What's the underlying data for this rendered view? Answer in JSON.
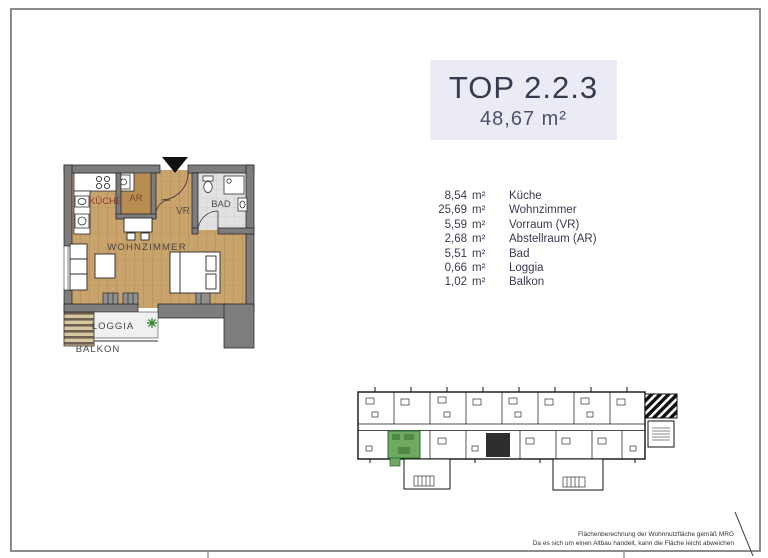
{
  "page": {
    "title": "TOP 2.2.3",
    "total_area": "48,67 m²"
  },
  "rooms": [
    {
      "area": "8,54",
      "unit": "m²",
      "name": "Küche"
    },
    {
      "area": "25,69",
      "unit": "m²",
      "name": "Wohnzimmer"
    },
    {
      "area": "5,59",
      "unit": "m²",
      "name": "Vorraum (VR)"
    },
    {
      "area": "2,68",
      "unit": "m²",
      "name": "Abstellraum (AR)"
    },
    {
      "area": "5,51",
      "unit": "m²",
      "name": "Bad"
    },
    {
      "area": "0,66",
      "unit": "m²",
      "name": "Loggia"
    },
    {
      "area": "1,02",
      "unit": "m²",
      "name": "Balkon"
    }
  ],
  "floorplan": {
    "labels": {
      "kueche": "KÜCHE",
      "ar": "AR",
      "vr": "VR",
      "bad": "BAD",
      "wohnzimmer": "WOHNZIMMER",
      "loggia": "LOGGIA",
      "balkon": "BALKON"
    }
  },
  "disclaimer": {
    "line1": "Flächenberechnung der Wohnnutzfläche gemäß MRG",
    "line2": "Da es sich um einen Altbau handelt, kann die Fläche leicht abweichen"
  },
  "colors": {
    "floor_wood": "#C9A36C",
    "floor_wood_dark": "#B78D51",
    "wall_gray": "#7D7D7D",
    "bad_floor": "#E1E1E1",
    "highlight_unit_green": "#6FA961",
    "title_box_bg": "#EBEBF5",
    "title_text": "#3A3A4F",
    "kueche_label": "#8B3A2E",
    "plant_green": "#2E8B2E"
  }
}
